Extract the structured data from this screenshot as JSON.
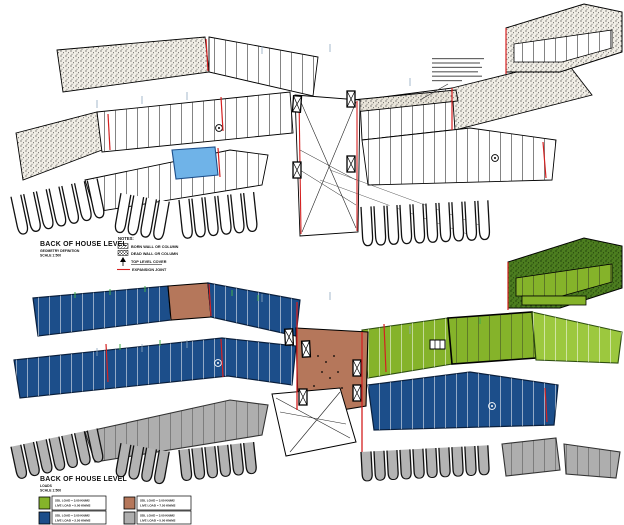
{
  "palette": {
    "blue": "#1c4e8a",
    "light_blue": "#6fb3e8",
    "green": "#85b32a",
    "light_green": "#9cc83e",
    "dark_green": "#4c7d1f",
    "brown": "#b5775b",
    "gray": "#aeaeae",
    "red": "#d42020"
  },
  "top_drawing": {
    "title": "BACK OF HOUSE LEVEL",
    "subtitle_line1": "GEOMETRY DEFINITION",
    "subtitle_line2": "SCALE 1:500",
    "notes": {
      "heading": "NOTES:",
      "born_wall": "BORN WALL OR COLUMN",
      "dead_wall": "DEAD WALL OR COLUMN",
      "top_level_cover": "TOP LEVEL COVER",
      "expansion_joint": "EXPANSION JOINT"
    }
  },
  "bottom_drawing": {
    "title": "BACK OF HOUSE LEVEL",
    "subtitle_line1": "LOADS",
    "subtitle_line2": "SCALE 1:500",
    "legend": {
      "items": [
        {
          "name": "green-area",
          "color": "#85b32a",
          "line1": "SDL LOAD = 3.00 KN/M2",
          "line2": "LIVE LOAD = 5.00 KN/M2"
        },
        {
          "name": "brown-area",
          "color": "#b5775b",
          "line1": "SDL LOAD = 3.00 KN/M2",
          "line2": "LIVE LOAD = 7.50 KN/M2"
        },
        {
          "name": "blue-area",
          "color": "#1c4e8a",
          "line1": "SDL LOAD = 3.00 KN/M2",
          "line2": "LIVE LOAD = 2.50 KN/M2"
        },
        {
          "name": "gray-area",
          "color": "#aeaeae",
          "line1": "SDL LOAD = 3.00 KN/M2",
          "line2": "LIVE LOAD = 5.00 KN/M2"
        }
      ]
    }
  }
}
